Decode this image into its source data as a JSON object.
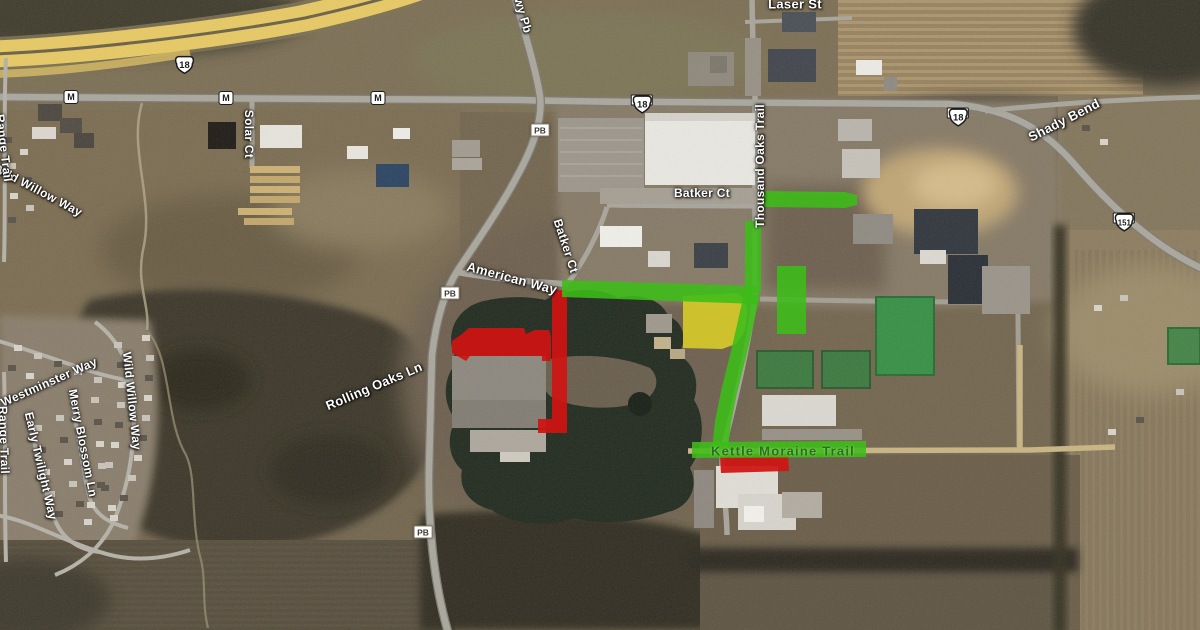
{
  "map": {
    "kind": "satellite-imagery-with-construction-overlays",
    "colors": {
      "overlay_green": "#3cbd18",
      "overlay_red": "#cf1412",
      "overlay_yellow": "#d2c72b",
      "road_label_text": "#ffffff",
      "trail_label_text": "#2d6e1c"
    },
    "overlays": [
      {
        "name": "highlight-yellow-parcel",
        "color": "yellow",
        "type": "polygon",
        "opacity": 0.95,
        "points": [
          [
            683,
            296
          ],
          [
            737,
            293
          ],
          [
            745,
            299
          ],
          [
            747,
            316
          ],
          [
            744,
            333
          ],
          [
            736,
            344
          ],
          [
            722,
            349
          ],
          [
            683,
            348
          ]
        ]
      },
      {
        "name": "highlight-red-batker-ct-south",
        "color": "red",
        "type": "polygon",
        "opacity": 0.93,
        "points": [
          [
            552,
            290
          ],
          [
            567,
            290
          ],
          [
            567,
            433
          ],
          [
            538,
            433
          ],
          [
            538,
            419
          ],
          [
            552,
            419
          ]
        ]
      },
      {
        "name": "highlight-red-building",
        "color": "red",
        "type": "polygon",
        "opacity": 0.93,
        "points": [
          [
            452,
            341
          ],
          [
            462,
            334
          ],
          [
            469,
            328
          ],
          [
            524,
            328
          ],
          [
            526,
            334
          ],
          [
            535,
            330
          ],
          [
            549,
            330
          ],
          [
            551,
            337
          ],
          [
            551,
            361
          ],
          [
            542,
            361
          ],
          [
            542,
            356
          ],
          [
            470,
            356
          ],
          [
            466,
            361
          ],
          [
            452,
            353
          ]
        ]
      },
      {
        "name": "highlight-red-kettle-moraine",
        "color": "red",
        "type": "polygon",
        "opacity": 0.93,
        "points": [
          [
            720,
            456
          ],
          [
            788,
            454
          ],
          [
            789,
            471
          ],
          [
            721,
            473
          ]
        ]
      },
      {
        "name": "highlight-green-batker-ct-east",
        "color": "green",
        "type": "polygon",
        "opacity": 0.88,
        "points": [
          [
            763,
            191
          ],
          [
            845,
            192
          ],
          [
            857,
            195
          ],
          [
            857,
            205
          ],
          [
            845,
            208
          ],
          [
            763,
            207
          ]
        ]
      },
      {
        "name": "highlight-green-thousand-oaks-north",
        "color": "green",
        "type": "polygon",
        "opacity": 0.88,
        "points": [
          [
            745,
            221
          ],
          [
            761,
            221
          ],
          [
            761,
            293
          ],
          [
            745,
            293
          ]
        ]
      },
      {
        "name": "highlight-green-american-way",
        "color": "green",
        "type": "polygon",
        "opacity": 0.88,
        "points": [
          [
            562,
            280
          ],
          [
            757,
            286
          ],
          [
            757,
            304
          ],
          [
            562,
            297
          ]
        ]
      },
      {
        "name": "highlight-green-thousand-oaks-south",
        "color": "green",
        "type": "stroke",
        "opacity": 0.88,
        "width": 16,
        "points": [
          [
            752,
            294
          ],
          [
            747,
            317
          ],
          [
            739,
            352
          ],
          [
            729,
            392
          ],
          [
            723,
            422
          ],
          [
            720,
            449
          ]
        ]
      },
      {
        "name": "highlight-green-kettle-moraine",
        "color": "green",
        "type": "polygon",
        "opacity": 0.88,
        "points": [
          [
            692,
            442
          ],
          [
            866,
            441
          ],
          [
            866,
            457
          ],
          [
            692,
            458
          ]
        ]
      },
      {
        "name": "highlight-green-parcel",
        "color": "green",
        "type": "polygon",
        "opacity": 0.88,
        "points": [
          [
            777,
            266
          ],
          [
            806,
            266
          ],
          [
            806,
            334
          ],
          [
            777,
            334
          ]
        ]
      }
    ],
    "street_labels": [
      {
        "text": "Laser St",
        "x": 795,
        "y": 4,
        "rot": 0,
        "size": 13,
        "kind": "road"
      },
      {
        "text": "Hwy Pb",
        "x": 522,
        "y": 11,
        "rot": 74,
        "size": 12,
        "kind": "road"
      },
      {
        "text": "Shady Bend",
        "x": 1064,
        "y": 120,
        "rot": -27,
        "size": 13,
        "kind": "road"
      },
      {
        "text": "Solar Ct",
        "x": 249,
        "y": 134,
        "rot": 90,
        "size": 12,
        "kind": "road"
      },
      {
        "text": "Batker Ct",
        "x": 702,
        "y": 193,
        "rot": 0,
        "size": 12,
        "kind": "road"
      },
      {
        "text": "Batker Ct",
        "x": 566,
        "y": 246,
        "rot": 72,
        "size": 12,
        "kind": "road"
      },
      {
        "text": "Thousand Oaks Trail",
        "x": 760,
        "y": 166,
        "rot": -90,
        "size": 12,
        "kind": "road"
      },
      {
        "text": "American Way",
        "x": 512,
        "y": 278,
        "rot": 15,
        "size": 13,
        "kind": "road"
      },
      {
        "text": "Rolling Oaks Ln",
        "x": 374,
        "y": 386,
        "rot": -23,
        "size": 13,
        "kind": "road"
      },
      {
        "text": "Westminster Way",
        "x": 49,
        "y": 382,
        "rot": -24,
        "size": 12,
        "kind": "road"
      },
      {
        "text": "Merry Blossom Ln",
        "x": 83,
        "y": 443,
        "rot": 79,
        "size": 12,
        "kind": "road"
      },
      {
        "text": "Early Twilight Way",
        "x": 41,
        "y": 466,
        "rot": 77,
        "size": 12,
        "kind": "road"
      },
      {
        "text": "Wild Willow Way",
        "x": 132,
        "y": 401,
        "rot": 84,
        "size": 12,
        "kind": "road"
      },
      {
        "text": "Wild Willow Way",
        "x": 38,
        "y": 190,
        "rot": 28,
        "size": 12,
        "kind": "road"
      },
      {
        "text": "Range Trail",
        "x": 4,
        "y": 148,
        "rot": 83,
        "size": 12,
        "kind": "road"
      },
      {
        "text": "Range Trail",
        "x": 4,
        "y": 440,
        "rot": 88,
        "size": 12,
        "kind": "road"
      },
      {
        "text": "Kettle Moraine Trail",
        "x": 783,
        "y": 451,
        "rot": 0,
        "size": 13,
        "kind": "trail"
      }
    ],
    "route_shields": [
      {
        "shape": "us",
        "text": "18",
        "alt": false,
        "x": 173,
        "y": 55
      },
      {
        "shape": "us",
        "text": "18",
        "alt": true,
        "x": 642,
        "y": 100
      },
      {
        "shape": "us",
        "text": "18",
        "alt": true,
        "x": 958,
        "y": 113
      },
      {
        "shape": "us",
        "text": "151",
        "alt": true,
        "x": 1124,
        "y": 218
      },
      {
        "shape": "county",
        "text": "M",
        "alt": false,
        "x": 71,
        "y": 97
      },
      {
        "shape": "county",
        "text": "M",
        "alt": false,
        "x": 226,
        "y": 98
      },
      {
        "shape": "county",
        "text": "M",
        "alt": false,
        "x": 378,
        "y": 98
      },
      {
        "shape": "box",
        "text": "PB",
        "alt": false,
        "x": 540,
        "y": 130
      },
      {
        "shape": "box",
        "text": "PB",
        "alt": false,
        "x": 450,
        "y": 293
      },
      {
        "shape": "box",
        "text": "PB",
        "alt": false,
        "x": 423,
        "y": 532
      }
    ]
  }
}
